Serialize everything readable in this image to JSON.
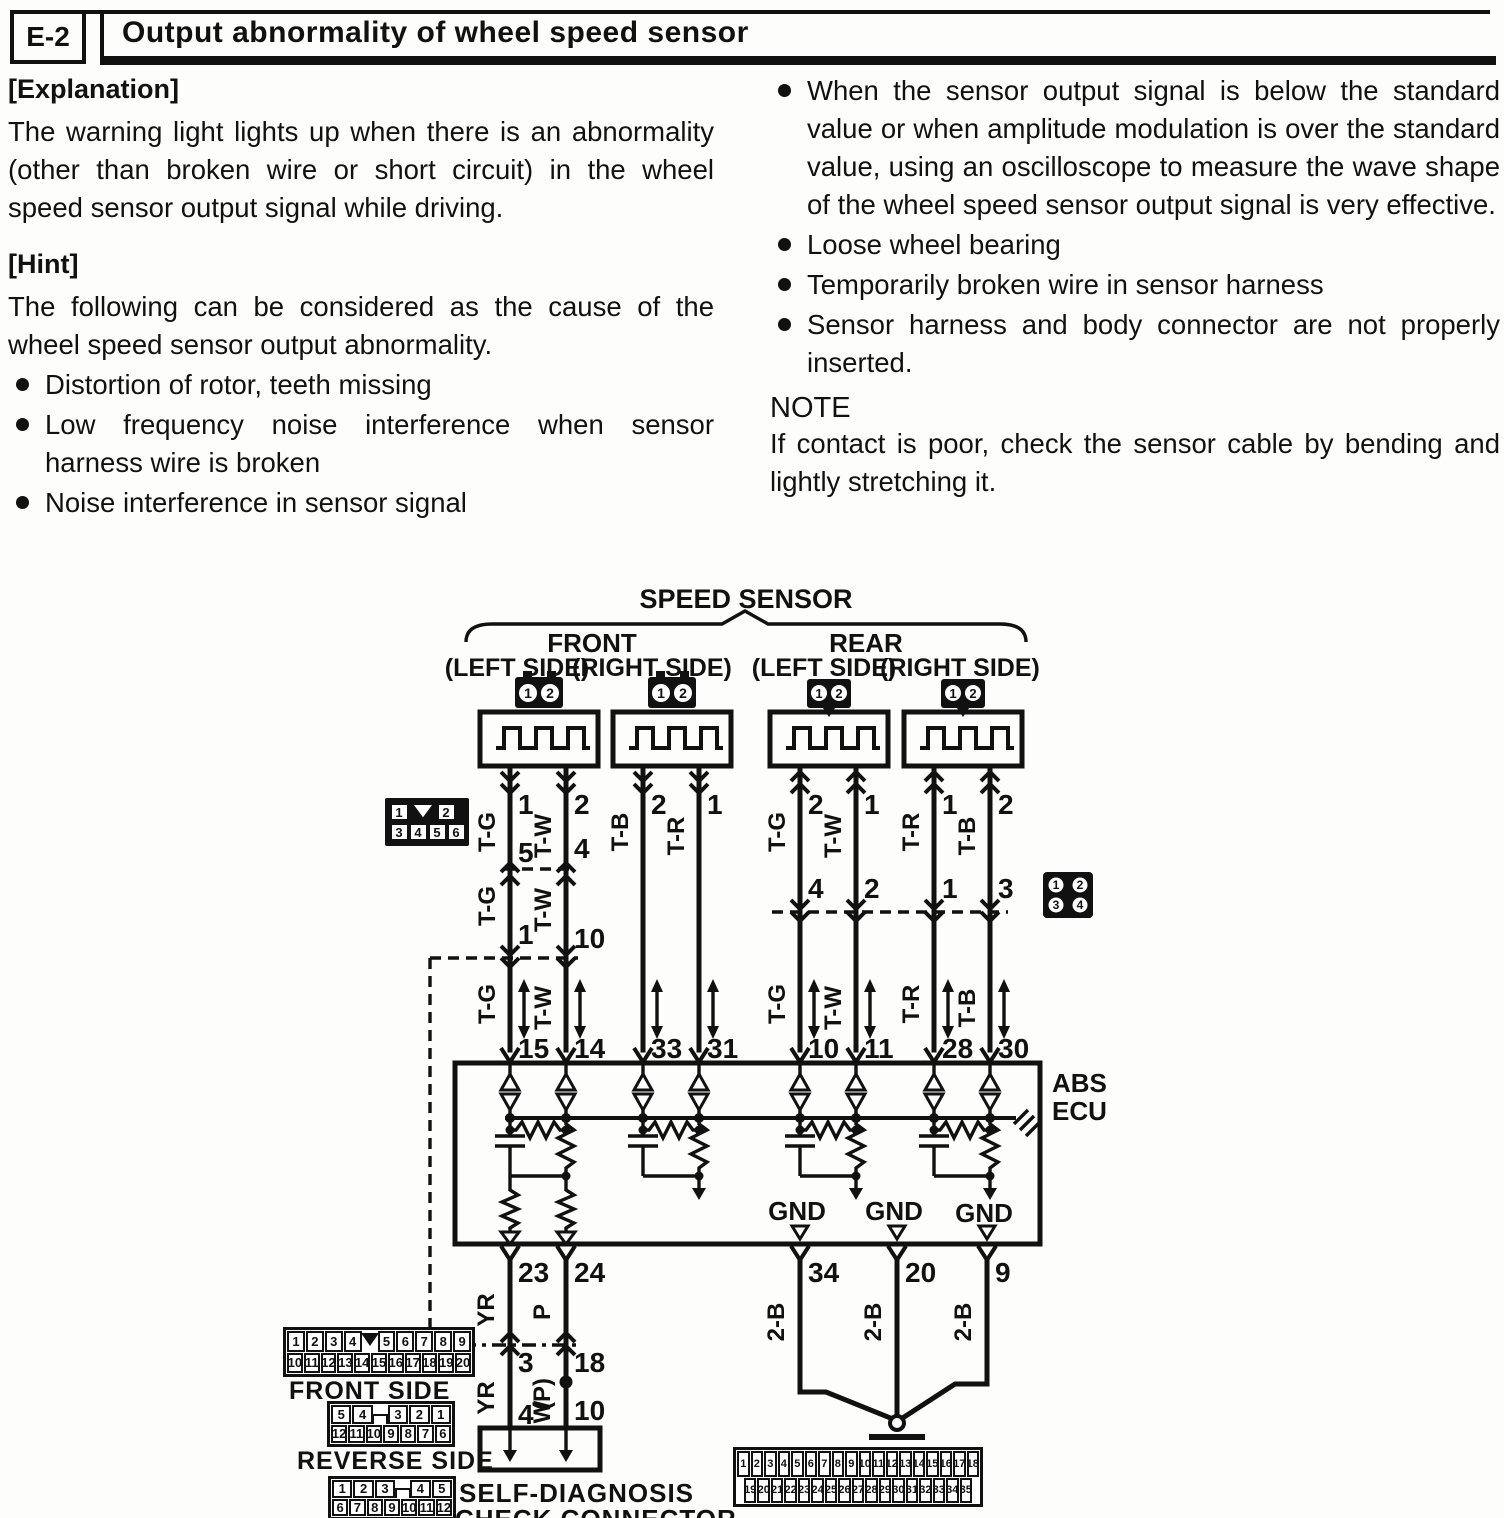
{
  "header": {
    "code": "E-2",
    "title": "Output abnormality of wheel speed sensor"
  },
  "explanation": {
    "heading": "[Explanation]",
    "body": "The warning light lights up when there is an abnormality (other than broken wire or short circuit) in the wheel speed sensor output signal while driving."
  },
  "hint": {
    "heading": "[Hint]",
    "intro": "The following can be considered as the cause of the wheel speed sensor output abnormality.",
    "bullets": [
      "Distortion of rotor, teeth missing",
      "Low frequency noise interference when sensor harness wire is broken",
      "Noise interference in sensor signal"
    ]
  },
  "right_column": {
    "bullets": [
      "When the sensor output signal is below the standard value or when amplitude modulation is over the standard value, using an oscilloscope to measure the wave shape of the wheel speed sensor output signal is very effective.",
      "Loose wheel bearing",
      "Temporarily broken wire in sensor harness",
      "Sensor harness and body connector are not properly inserted."
    ],
    "note_heading": "NOTE",
    "note_body": "If contact is poor, check the sensor cable by bending and lightly stretching it."
  },
  "diagram": {
    "title": "SPEED SENSOR",
    "front": "FRONT",
    "rear": "REAR",
    "left_side": "(LEFT SIDE)",
    "right_side": "(RIGHT SIDE)",
    "abs": "ABS",
    "ecu": "ECU",
    "gnd": "GND",
    "front_side_label": "FRONT SIDE",
    "reverse_side_label": "REVERSE SIDE",
    "self_diag1": "SELF-DIAGNOSIS",
    "self_diag2": "CHECK CONNECTOR",
    "branches": [
      {
        "id": "front-left",
        "colors": [
          "T-G",
          "T-W"
        ],
        "sensor_pins": [
          "1",
          "2"
        ],
        "joint1_pins": [
          "5",
          "4"
        ],
        "joint2_pins": [
          "1",
          "10"
        ],
        "ecu_pins": [
          "15",
          "14"
        ]
      },
      {
        "id": "front-right",
        "colors": [
          "T-B",
          "T-R"
        ],
        "sensor_pins": [
          "2",
          "1"
        ],
        "ecu_pins": [
          "33",
          "31"
        ]
      },
      {
        "id": "rear-left",
        "colors": [
          "T-G",
          "T-W"
        ],
        "sensor_pins": [
          "2",
          "1"
        ],
        "joint_pins": [
          "4",
          "2"
        ],
        "ecu_pins": [
          "10",
          "11"
        ]
      },
      {
        "id": "rear-right",
        "colors": [
          "T-R",
          "T-B"
        ],
        "sensor_pins": [
          "1",
          "2"
        ],
        "joint_pins": [
          "1",
          "3"
        ],
        "ecu_pins": [
          "28",
          "30"
        ]
      }
    ],
    "ecu_bottom": {
      "diag_pins": [
        "23",
        "24"
      ],
      "gnd_pins": [
        "34",
        "20",
        "9"
      ],
      "diag_wires": [
        "YR",
        "P"
      ],
      "diag_joint_pins": [
        "3",
        "18"
      ],
      "diag_wires2": [
        "YR",
        "(P)"
      ],
      "w_wire": "W",
      "diag_conn_pins": [
        "4",
        "10"
      ],
      "gnd_wire": "2-B"
    },
    "connectors": {
      "sensor_plug": {
        "pins": [
          "1",
          "2"
        ]
      },
      "inline6": {
        "row1": [
          "1",
          "2"
        ],
        "row2": [
          "3",
          "4",
          "5",
          "6"
        ]
      },
      "inline4": {
        "row1": [
          "1",
          "2"
        ],
        "row2": [
          "3",
          "4"
        ]
      },
      "front_side": {
        "row1": [
          "1",
          "2",
          "3",
          "4",
          "5",
          "6",
          "7",
          "8",
          "9"
        ],
        "row2": [
          "10",
          "11",
          "12",
          "13",
          "14",
          "15",
          "16",
          "17",
          "18",
          "19",
          "20"
        ]
      },
      "reverse_side": {
        "row1": [
          "5",
          "4",
          "3",
          "2",
          "1"
        ],
        "row2": [
          "12",
          "11",
          "10",
          "9",
          "8",
          "7",
          "6"
        ]
      },
      "check12": {
        "row1": [
          "1",
          "2",
          "3",
          "4",
          "5"
        ],
        "row2": [
          "6",
          "7",
          "8",
          "9",
          "10",
          "11",
          "12"
        ]
      },
      "abs35": {
        "row1": [
          "1",
          "2",
          "3",
          "4",
          "5",
          "6",
          "7",
          "8",
          "9",
          "10",
          "11",
          "12",
          "13",
          "14",
          "15",
          "16",
          "17",
          "18"
        ],
        "row2": [
          "19",
          "20",
          "21",
          "22",
          "23",
          "24",
          "25",
          "26",
          "27",
          "28",
          "29",
          "30",
          "31",
          "32",
          "33",
          "34",
          "35"
        ]
      }
    }
  }
}
